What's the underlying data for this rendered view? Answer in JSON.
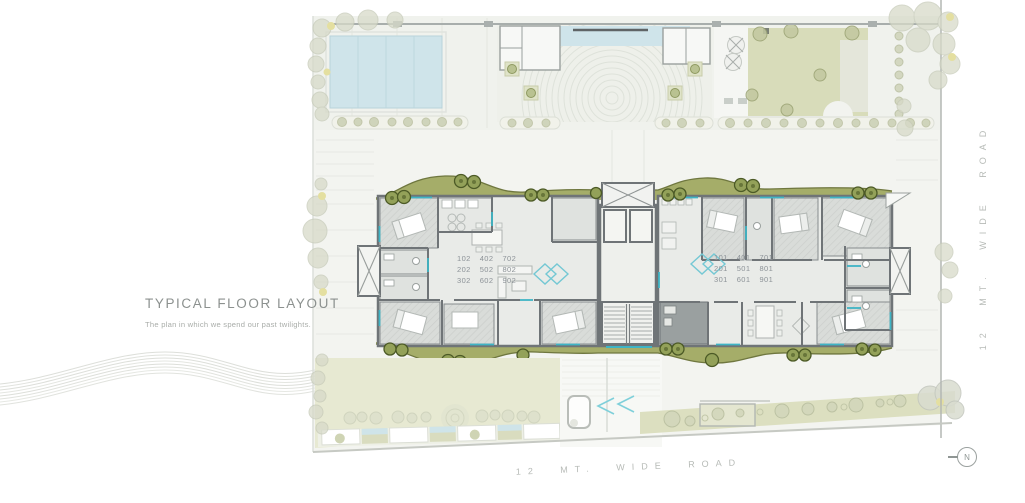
{
  "title_block": {
    "title": "TYPICAL FLOOR LAYOUT",
    "subtitle": "The plan in  which we spend our past twilights."
  },
  "units": {
    "left": [
      [
        "102",
        "402",
        "702"
      ],
      [
        "202",
        "502",
        "802"
      ],
      [
        "302",
        "602",
        "902"
      ]
    ],
    "right": [
      [
        "101",
        "401",
        "701"
      ],
      [
        "201",
        "501",
        "801"
      ],
      [
        "301",
        "601",
        "901"
      ]
    ]
  },
  "roads": {
    "right": "12 MT. WIDE ROAD",
    "bottom": "12 MT. WIDE ROAD"
  },
  "compass": {
    "label": "N"
  },
  "colors": {
    "site_bg": "#f3f4f0",
    "lawn_green": "#d8dcba",
    "band_green": "#a5ad69",
    "pool_blue": "#cfe4ea",
    "accent_teal": "#3eb4c5",
    "wall_gray": "#6f7477",
    "text_gray": "#8d9398",
    "road_text": "#b7bbb7"
  }
}
